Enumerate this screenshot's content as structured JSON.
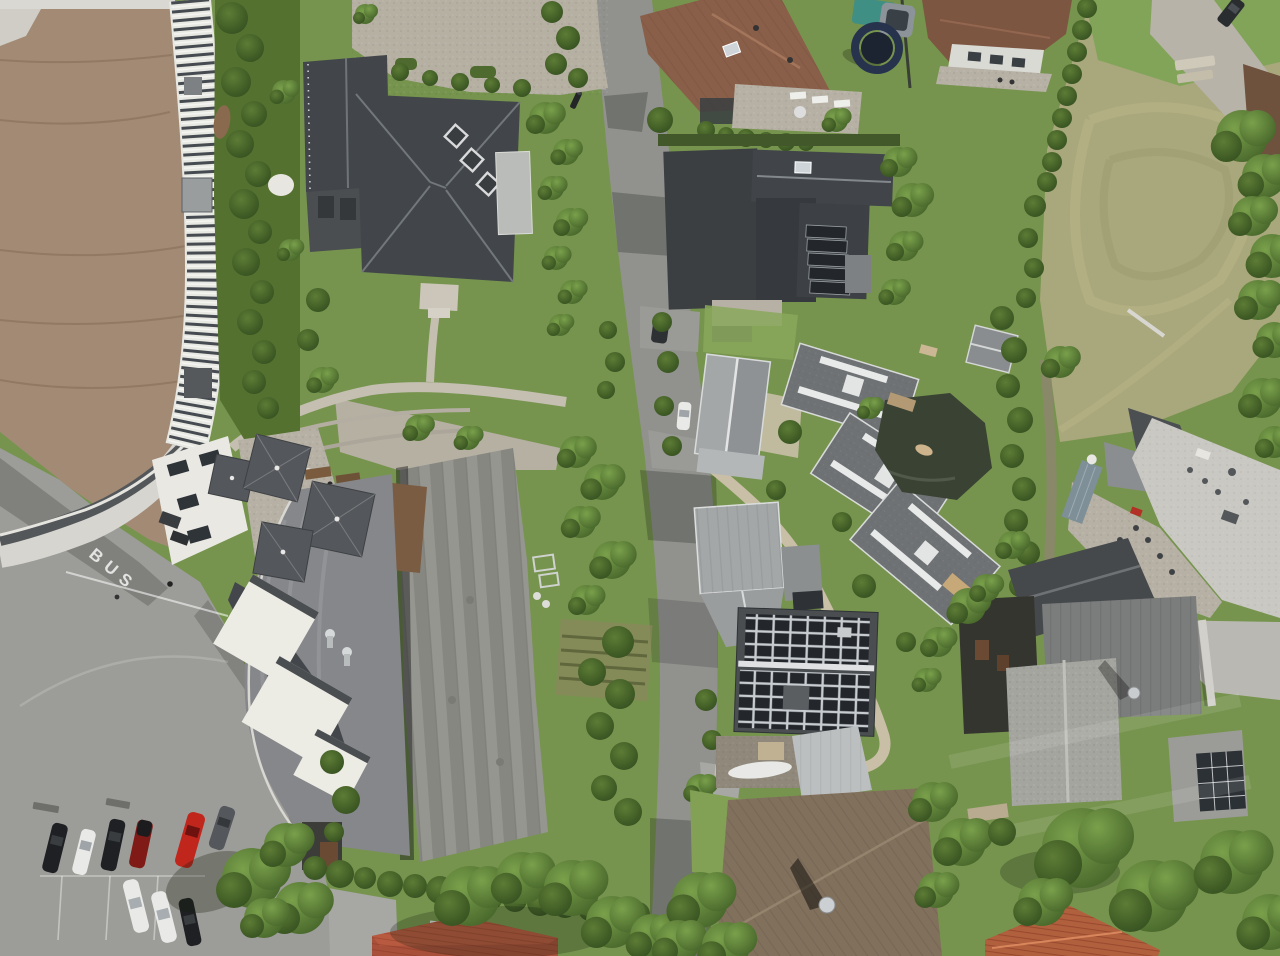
{
  "scene": {
    "type": "aerial-drone-photograph",
    "description": "Top-down aerial view of an alpine village block: curved-roof arena with louvered skylight band (top left), large dark hip-roof villa with dormers, a street running top to bottom, brown-roof houses and gardens (top right), a dry meadow field, a cluster of modern gray-roof houses with a pond, a house fully covered in solar panels, large gray warehouse and restaurant roofs with parasols and white awnings, and a parking lot with cars (bottom left)",
    "road_marking": "BUS"
  },
  "palette": {
    "grass": "#76944e",
    "grass_bright": "#86a857",
    "field": "#a9a77c",
    "asphalt": "#9c9c98",
    "road": "#91928e",
    "arena_roof": "#a28a75",
    "walkway": "#d7d5cf",
    "louver_dark": "#454b50",
    "villa_roof": "#42464a",
    "dark_roof": "#3b3f42",
    "warehouse_roof": "#8f8f89",
    "restaurant_roof": "#86878b",
    "metal_roof": "#a4a7a8",
    "shingle_gray": "#6f7274",
    "brown_roof_a": "#8a5f49",
    "brown_roof_j": "#81705c",
    "red_tile": "#a8503a",
    "orange_tile": "#b1603e",
    "flat_roof": "#c9c8c3",
    "solar": "#23272c",
    "pond": "#3a4233",
    "pool": "#7e8f97",
    "teal_pool": "#3f8f85",
    "trampoline": "#27334d",
    "umbrella": "#54575b",
    "awning": "#ecebe4",
    "stone": "#b7b1a5",
    "gravel": "#b6b0a3",
    "sand": "#c9bfa7",
    "car_white": "#e9e9e7",
    "car_black": "#1e2023",
    "car_red": "#c1261d",
    "car_dark_red": "#801a17",
    "car_gray": "#54575b"
  },
  "parking": {
    "marking": "BUS",
    "cars_upper_row": [
      "black",
      "white",
      "black",
      "dark-red",
      "red",
      "gray"
    ],
    "cars_lower_row": [
      "white",
      "white",
      "black"
    ]
  },
  "features": {
    "parasols": 4,
    "white_awnings": 3,
    "solar_roof_houses": 3,
    "modern_gray_houses": 3,
    "trampoline": 1,
    "pond": 1,
    "lap_pool": 1
  }
}
